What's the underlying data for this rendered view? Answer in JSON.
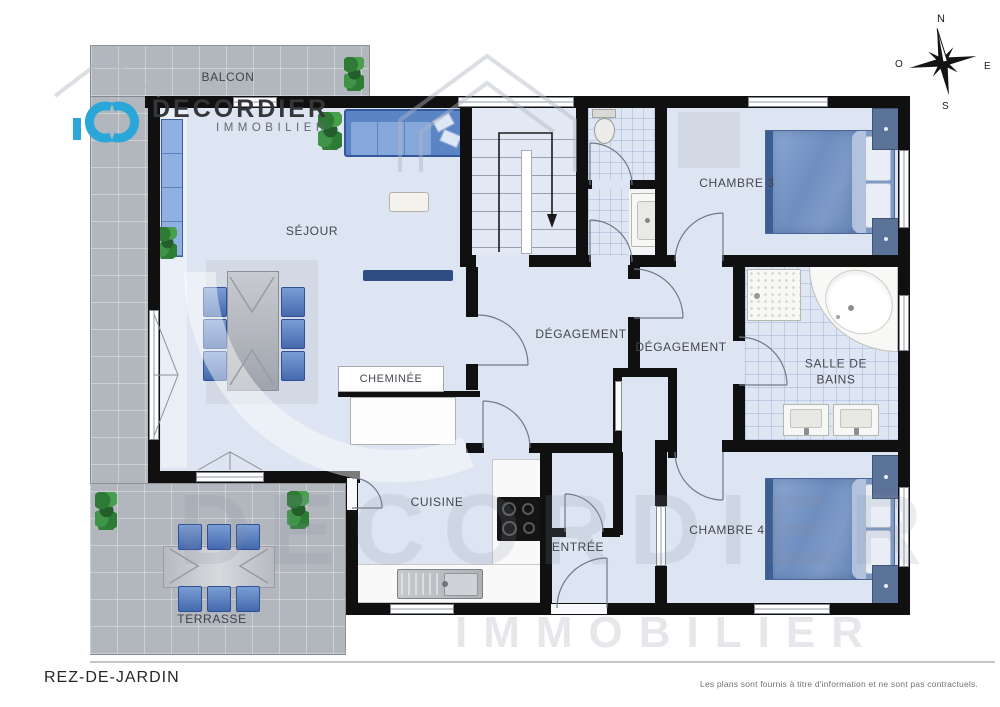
{
  "brand": {
    "name": "DECORDIER",
    "tagline": "IMMOBILIER"
  },
  "compass": {
    "north": "N",
    "south": "S",
    "east": "E",
    "west": "O"
  },
  "rooms": {
    "balcon": "BALCON",
    "sejour": "SÉJOUR",
    "chambre3": "CHAMBRE 3",
    "chambre4": "CHAMBRE 4",
    "degagement1": "DÉGAGEMENT",
    "degagement2": "DÉGAGEMENT",
    "salle_de_bains": "SALLE DE BAINS",
    "cheminee": "CHEMINÉE",
    "cuisine": "CUISINE",
    "entree": "ENTRÉE",
    "terrasse": "TERRASSE"
  },
  "footer": {
    "level_name": "REZ-DE-JARDIN",
    "disclaimer": "Les plans sont fournis à titre d'information et ne sont pas contractuels."
  },
  "watermark": {
    "line1": "DECORDIER",
    "line2": "IMMOBILIER"
  },
  "colors": {
    "brand_blue": "#2aa7d8",
    "wall_black": "#101010",
    "floor_blue": "#dde5f2",
    "outdoor_tile_gray": "#b2b6bd",
    "furniture_blue": "#5b84c4"
  }
}
